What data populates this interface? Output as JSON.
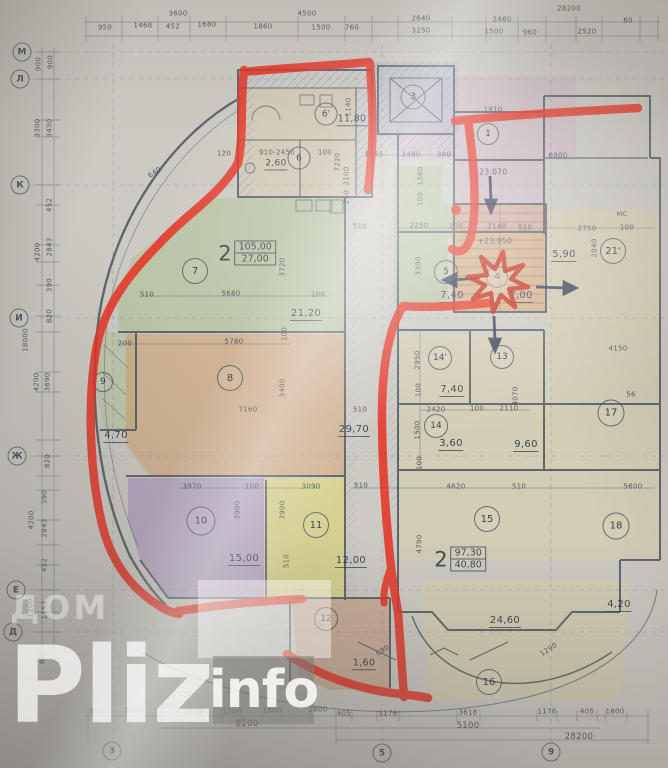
{
  "watermark": {
    "line1": "ДОМ",
    "brand": "Pliz",
    "suffix": "info"
  },
  "colors": {
    "marker_red": "#e63022",
    "arrow_navy": "#27304f",
    "pencil_green": "#a9c08d",
    "pencil_orange": "#d49a62",
    "pencil_purple": "#9f86bd",
    "pencil_yellow": "#e3da60",
    "pencil_pink": "#cfa8c6",
    "pencil_blue_hatch": "#7d9cc8",
    "line_ink": "#3e4a58"
  },
  "apartments": [
    {
      "num": "2",
      "total": "105,00",
      "living": "27,00",
      "x": 247,
      "y": 253
    },
    {
      "num": "2",
      "total": "97,30",
      "living": "40,80",
      "x": 460,
      "y": 559
    }
  ],
  "axes": [
    {
      "t": "М",
      "x": 22,
      "y": 52
    },
    {
      "t": "Л",
      "x": 20,
      "y": 79
    },
    {
      "t": "К",
      "x": 20,
      "y": 185
    },
    {
      "t": "И",
      "x": 19,
      "y": 318
    },
    {
      "t": "Ж",
      "x": 17,
      "y": 456
    },
    {
      "t": "Е",
      "x": 16,
      "y": 590
    },
    {
      "t": "Д",
      "x": 13,
      "y": 632
    },
    {
      "t": "3",
      "x": 112,
      "y": 751
    },
    {
      "t": "5",
      "x": 382,
      "y": 753
    },
    {
      "t": "9",
      "x": 551,
      "y": 752
    }
  ],
  "rooms": [
    {
      "t": "6'",
      "x": 326,
      "y": 114,
      "d": 21
    },
    {
      "t": "6",
      "x": 299,
      "y": 158,
      "d": 21
    },
    {
      "t": "3",
      "x": 413,
      "y": 97,
      "d": 23
    },
    {
      "t": "1",
      "x": 488,
      "y": 134,
      "d": 20
    },
    {
      "t": "7",
      "x": 195,
      "y": 271,
      "d": 24
    },
    {
      "t": "5",
      "x": 446,
      "y": 272,
      "d": 22
    },
    {
      "t": "4",
      "x": 497,
      "y": 277,
      "d": 20
    },
    {
      "t": "21'",
      "x": 613,
      "y": 251,
      "d": 24
    },
    {
      "t": "8",
      "x": 230,
      "y": 378,
      "d": 24
    },
    {
      "t": "9",
      "x": 103,
      "y": 382,
      "d": 18
    },
    {
      "t": "14'",
      "x": 440,
      "y": 358,
      "d": 22
    },
    {
      "t": "13",
      "x": 502,
      "y": 357,
      "d": 22
    },
    {
      "t": "14",
      "x": 436,
      "y": 426,
      "d": 22
    },
    {
      "t": "17",
      "x": 611,
      "y": 413,
      "d": 25
    },
    {
      "t": "10",
      "x": 201,
      "y": 521,
      "d": 27
    },
    {
      "t": "11",
      "x": 316,
      "y": 525,
      "d": 24
    },
    {
      "t": "15",
      "x": 487,
      "y": 519,
      "d": 24
    },
    {
      "t": "18",
      "x": 616,
      "y": 526,
      "d": 25
    },
    {
      "t": "12",
      "x": 326,
      "y": 619,
      "d": 22
    },
    {
      "t": "16",
      "x": 489,
      "y": 682,
      "d": 24
    }
  ],
  "labels": [
    {
      "t": "3600",
      "x": 178,
      "y": 14
    },
    {
      "t": "4500",
      "x": 307,
      "y": 14
    },
    {
      "t": "2640",
      "x": 421,
      "y": 19
    },
    {
      "t": "2460",
      "x": 502,
      "y": 20
    },
    {
      "t": "28200",
      "x": 569,
      "y": 9
    },
    {
      "t": "60",
      "x": 628,
      "y": 21
    },
    {
      "t": "950",
      "x": 105,
      "y": 28
    },
    {
      "t": "1468",
      "x": 143,
      "y": 26
    },
    {
      "t": "452",
      "x": 173,
      "y": 27
    },
    {
      "t": "1680",
      "x": 207,
      "y": 25
    },
    {
      "t": "1860",
      "x": 263,
      "y": 27
    },
    {
      "t": "1500",
      "x": 321,
      "y": 28
    },
    {
      "t": "760",
      "x": 352,
      "y": 28
    },
    {
      "t": "3250",
      "x": 421,
      "y": 31
    },
    {
      "t": "1500",
      "x": 494,
      "y": 32
    },
    {
      "t": "960",
      "x": 530,
      "y": 33
    },
    {
      "t": "2520",
      "x": 587,
      "y": 32
    },
    {
      "t": "900",
      "x": 39,
      "y": 64,
      "r": 1
    },
    {
      "t": "900",
      "x": 51,
      "y": 62,
      "r": 1
    },
    {
      "t": "3300",
      "x": 38,
      "y": 128,
      "r": 1
    },
    {
      "t": "3430",
      "x": 50,
      "y": 128,
      "r": 1
    },
    {
      "t": "452",
      "x": 50,
      "y": 205,
      "r": 1
    },
    {
      "t": "2843",
      "x": 50,
      "y": 247,
      "r": 1
    },
    {
      "t": "4200",
      "x": 38,
      "y": 252,
      "r": 1
    },
    {
      "t": "390",
      "x": 50,
      "y": 285,
      "r": 1
    },
    {
      "t": "820",
      "x": 50,
      "y": 316,
      "r": 1
    },
    {
      "t": "18000",
      "x": 26,
      "y": 340,
      "r": 1
    },
    {
      "t": "4200",
      "x": 37,
      "y": 382,
      "r": 1
    },
    {
      "t": "3690",
      "x": 48,
      "y": 382,
      "r": 1
    },
    {
      "t": "820",
      "x": 48,
      "y": 461,
      "r": 1
    },
    {
      "t": "390",
      "x": 45,
      "y": 497,
      "r": 1
    },
    {
      "t": "4200",
      "x": 32,
      "y": 520,
      "r": 1
    },
    {
      "t": "2843",
      "x": 45,
      "y": 528,
      "r": 1
    },
    {
      "t": "452",
      "x": 45,
      "y": 565,
      "r": 1
    },
    {
      "t": "1200",
      "x": 31,
      "y": 608,
      "r": 1
    },
    {
      "t": "1152",
      "x": 45,
      "y": 610,
      "r": 1
    },
    {
      "t": "891",
      "x": 43,
      "y": 657,
      "r": 1
    },
    {
      "t": "120",
      "x": 224,
      "y": 154
    },
    {
      "t": "640",
      "x": 155,
      "y": 173,
      "cl": "d1"
    },
    {
      "t": "910-2450",
      "x": 277,
      "y": 153
    },
    {
      "t": "2,60",
      "x": 276,
      "y": 165,
      "cl": "area",
      "s": 9
    },
    {
      "t": "100",
      "x": 325,
      "y": 153
    },
    {
      "t": "11,80",
      "x": 352,
      "y": 120,
      "cl": "area",
      "s": 9.5
    },
    {
      "t": "1140",
      "x": 349,
      "y": 107,
      "r": 1
    },
    {
      "t": "2100",
      "x": 347,
      "y": 176,
      "r": 1
    },
    {
      "t": "250",
      "x": 347,
      "y": 197,
      "r": 1
    },
    {
      "t": "1055",
      "x": 374,
      "y": 155
    },
    {
      "t": "2490",
      "x": 411,
      "y": 155
    },
    {
      "t": "380",
      "x": 444,
      "y": 155
    },
    {
      "t": "1560",
      "x": 421,
      "y": 176,
      "r": 1
    },
    {
      "t": "100",
      "x": 421,
      "y": 199,
      "r": 1
    },
    {
      "t": "7220",
      "x": 338,
      "y": 162,
      "r": 1
    },
    {
      "t": "1910",
      "x": 493,
      "y": 110
    },
    {
      "t": "6900",
      "x": 558,
      "y": 156
    },
    {
      "t": "+23.070",
      "x": 490,
      "y": 172,
      "cl": "elev",
      "s": 7.5
    },
    {
      "t": "+23.050",
      "x": 495,
      "y": 241,
      "cl": "elev",
      "s": 7.5
    },
    {
      "t": "510",
      "x": 360,
      "y": 227
    },
    {
      "t": "2250",
      "x": 419,
      "y": 226
    },
    {
      "t": "200",
      "x": 456,
      "y": 227
    },
    {
      "t": "2140",
      "x": 497,
      "y": 227
    },
    {
      "t": "510",
      "x": 525,
      "y": 228
    },
    {
      "t": "2750",
      "x": 587,
      "y": 229
    },
    {
      "t": "100",
      "x": 627,
      "y": 228
    },
    {
      "t": "МС",
      "x": 622,
      "y": 214,
      "s": 6.5
    },
    {
      "t": "2040",
      "x": 595,
      "y": 248,
      "r": 1
    },
    {
      "t": "5,90",
      "x": 564,
      "y": 256,
      "cl": "area",
      "s": 10
    },
    {
      "t": "3300",
      "x": 419,
      "y": 266,
      "r": 1
    },
    {
      "t": "7,40",
      "x": 452,
      "y": 297,
      "cl": "area",
      "s": 10
    },
    {
      "t": "7,00",
      "x": 521,
      "y": 297,
      "cl": "area",
      "s": 10
    },
    {
      "t": "5680",
      "x": 231,
      "y": 294
    },
    {
      "t": "510",
      "x": 147,
      "y": 295
    },
    {
      "t": "100",
      "x": 318,
      "y": 295
    },
    {
      "t": "3720",
      "x": 283,
      "y": 267,
      "r": 1
    },
    {
      "t": "21,20",
      "x": 306,
      "y": 315,
      "cl": "area",
      "s": 10
    },
    {
      "t": "5780",
      "x": 234,
      "y": 342
    },
    {
      "t": "100",
      "x": 285,
      "y": 334,
      "r": 1
    },
    {
      "t": "200",
      "x": 125,
      "y": 344
    },
    {
      "t": "3400",
      "x": 283,
      "y": 388,
      "r": 1
    },
    {
      "t": "7160",
      "x": 248,
      "y": 410
    },
    {
      "t": "4,70",
      "x": 116,
      "y": 437,
      "cl": "area",
      "s": 10
    },
    {
      "t": "2950",
      "x": 418,
      "y": 360,
      "r": 1
    },
    {
      "t": "7,40",
      "x": 452,
      "y": 391,
      "cl": "area",
      "s": 10
    },
    {
      "t": "4150",
      "x": 618,
      "y": 349
    },
    {
      "t": "4070",
      "x": 516,
      "y": 396,
      "r": 1
    },
    {
      "t": "100",
      "x": 419,
      "y": 390,
      "r": 1
    },
    {
      "t": "2420",
      "x": 436,
      "y": 410
    },
    {
      "t": "100",
      "x": 477,
      "y": 409
    },
    {
      "t": "2110",
      "x": 509,
      "y": 409
    },
    {
      "t": "1500",
      "x": 418,
      "y": 430,
      "r": 1
    },
    {
      "t": "3,60",
      "x": 451,
      "y": 445,
      "cl": "area",
      "s": 10
    },
    {
      "t": "9,60",
      "x": 526,
      "y": 446,
      "cl": "area",
      "s": 10
    },
    {
      "t": "29,70",
      "x": 354,
      "y": 431,
      "cl": "area",
      "s": 10
    },
    {
      "t": "100",
      "x": 420,
      "y": 463,
      "r": 1
    },
    {
      "t": "510",
      "x": 360,
      "y": 410
    },
    {
      "t": "510",
      "x": 361,
      "y": 486
    },
    {
      "t": "4620",
      "x": 456,
      "y": 487
    },
    {
      "t": "510",
      "x": 519,
      "y": 487
    },
    {
      "t": "5600",
      "x": 633,
      "y": 487
    },
    {
      "t": "56",
      "x": 631,
      "y": 395
    },
    {
      "t": "3970",
      "x": 192,
      "y": 487
    },
    {
      "t": "100",
      "x": 252,
      "y": 487
    },
    {
      "t": "3090",
      "x": 311,
      "y": 487
    },
    {
      "t": "3900",
      "x": 238,
      "y": 510,
      "r": 1
    },
    {
      "t": "3900",
      "x": 283,
      "y": 510,
      "r": 1
    },
    {
      "t": "510",
      "x": 287,
      "y": 561,
      "r": 1
    },
    {
      "t": "15,00",
      "x": 244,
      "y": 560,
      "cl": "area",
      "s": 10
    },
    {
      "t": "12,00",
      "x": 351,
      "y": 562,
      "cl": "area",
      "s": 10
    },
    {
      "t": "4790",
      "x": 420,
      "y": 544,
      "r": 1
    },
    {
      "t": "24,60",
      "x": 505,
      "y": 622,
      "cl": "area",
      "s": 10
    },
    {
      "t": "4,20",
      "x": 619,
      "y": 606,
      "cl": "area",
      "s": 10
    },
    {
      "t": "1,60",
      "x": 364,
      "y": 664,
      "cl": "area",
      "s": 9.5
    },
    {
      "t": "690",
      "x": 383,
      "y": 651,
      "cl": "d1"
    },
    {
      "t": "1290",
      "x": 549,
      "y": 650,
      "cl": "d1"
    },
    {
      "t": "950",
      "x": 97,
      "y": 712
    },
    {
      "t": "1468",
      "x": 134,
      "y": 711
    },
    {
      "t": "452",
      "x": 168,
      "y": 706
    },
    {
      "t": "1090",
      "x": 193,
      "y": 713
    },
    {
      "t": "1200",
      "x": 232,
      "y": 712
    },
    {
      "t": "1300",
      "x": 272,
      "y": 711
    },
    {
      "t": "1800",
      "x": 318,
      "y": 710
    },
    {
      "t": "405",
      "x": 344,
      "y": 714
    },
    {
      "t": "1176",
      "x": 388,
      "y": 714
    },
    {
      "t": "3618",
      "x": 468,
      "y": 713
    },
    {
      "t": "1176",
      "x": 547,
      "y": 712
    },
    {
      "t": "405",
      "x": 587,
      "y": 712
    },
    {
      "t": "1800",
      "x": 615,
      "y": 712
    },
    {
      "t": "8100",
      "x": 247,
      "y": 724,
      "s": 8.5
    },
    {
      "t": "5100",
      "x": 468,
      "y": 726,
      "s": 8.5
    },
    {
      "t": "28200",
      "x": 579,
      "y": 737,
      "s": 8.5
    }
  ]
}
